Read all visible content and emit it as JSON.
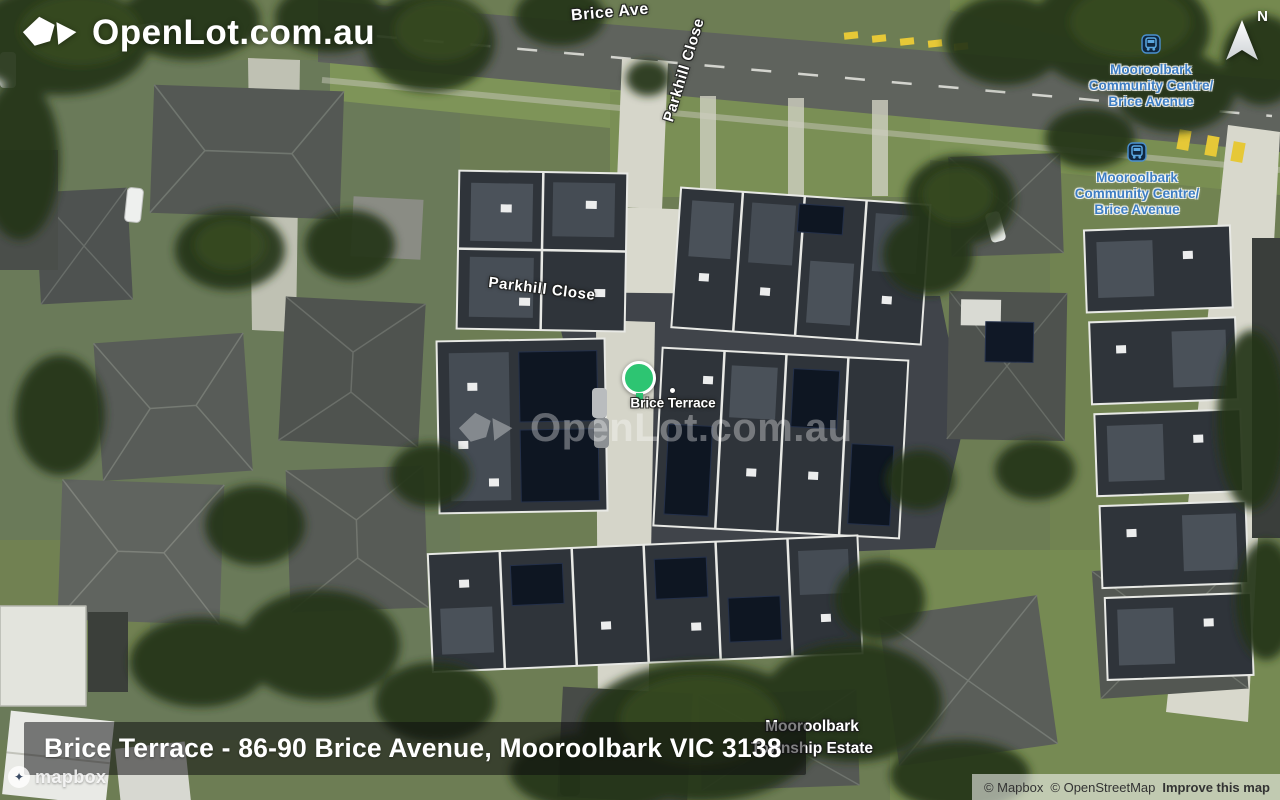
{
  "branding": {
    "logo_text": "OpenLot.com.au",
    "watermark_text": "OpenLot.com.au"
  },
  "compass": {
    "label": "N"
  },
  "streets": {
    "brice_ave": "Brice Ave",
    "parkhill_vertical": "Parkhill Close",
    "parkhill_horizontal": "Parkhill Close"
  },
  "transit": {
    "color": "#3d7dc2",
    "stops": [
      {
        "line1": "Mooroolbark",
        "line2": "Community Centre/",
        "line3": "Brice Avenue"
      },
      {
        "line1": "Mooroolbark",
        "line2": "Community Centre/",
        "line3": "Brice Avenue"
      }
    ]
  },
  "marker": {
    "label": "Brice Terrace",
    "color": "#2dc572"
  },
  "estate": {
    "line1": "Mooroolbark",
    "line2": "Township Estate"
  },
  "address_bar": {
    "text": "Brice Terrace - 86-90 Brice Avenue, Mooroolbark VIC 3138"
  },
  "attribution": {
    "wordmark": "mapbox",
    "copyright_mapbox": "© Mapbox",
    "copyright_osm": "© OpenStreetMap",
    "improve_link": "Improve this map"
  }
}
